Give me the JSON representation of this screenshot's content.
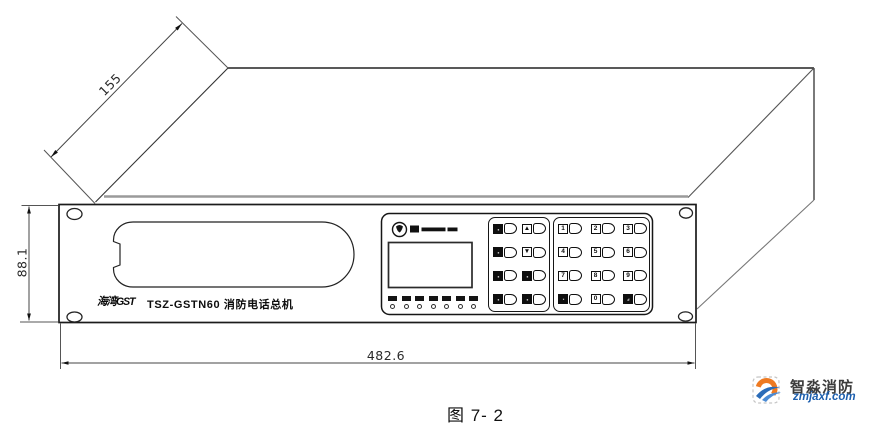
{
  "figure": {
    "caption": "图 7- 2"
  },
  "dimensions": {
    "depth_mm": "155",
    "height_mm": "88.1",
    "width_mm": "482.6"
  },
  "panel": {
    "brand_mark": "海湾GST",
    "model_label": "TSZ-GSTN60 消防电话总机"
  },
  "indicators": {
    "count": 7
  },
  "keypad_function": {
    "keys": [
      {
        "glyph": "▪▪",
        "filled": true
      },
      {
        "glyph": "▲",
        "filled": false
      },
      {
        "glyph": "▪▪",
        "filled": true
      },
      {
        "glyph": "▼",
        "filled": false
      },
      {
        "glyph": "▪▪",
        "filled": true
      },
      {
        "glyph": "▪▪",
        "filled": true
      },
      {
        "glyph": "▪▪",
        "filled": true
      },
      {
        "glyph": "▪▪",
        "filled": true
      }
    ]
  },
  "keypad_numeric": {
    "keys": [
      {
        "glyph": "1",
        "filled": false
      },
      {
        "glyph": "2",
        "filled": false
      },
      {
        "glyph": "3",
        "filled": false
      },
      {
        "glyph": "4",
        "filled": false
      },
      {
        "glyph": "5",
        "filled": false
      },
      {
        "glyph": "6",
        "filled": false
      },
      {
        "glyph": "7",
        "filled": false
      },
      {
        "glyph": "8",
        "filled": false
      },
      {
        "glyph": "9",
        "filled": false
      },
      {
        "glyph": "*",
        "filled": true
      },
      {
        "glyph": "0",
        "filled": false
      },
      {
        "glyph": "#",
        "filled": true
      }
    ]
  },
  "watermark": {
    "title": "智淼消防",
    "url": "zmjaxf.com"
  },
  "colors": {
    "line": "#222222",
    "lip_line": "#9a9a9a",
    "dim_line": "#444444",
    "wm_blue": "#1d5fae",
    "wm_orange": "#ee7a22",
    "wm_text": "#3c3c3c"
  }
}
